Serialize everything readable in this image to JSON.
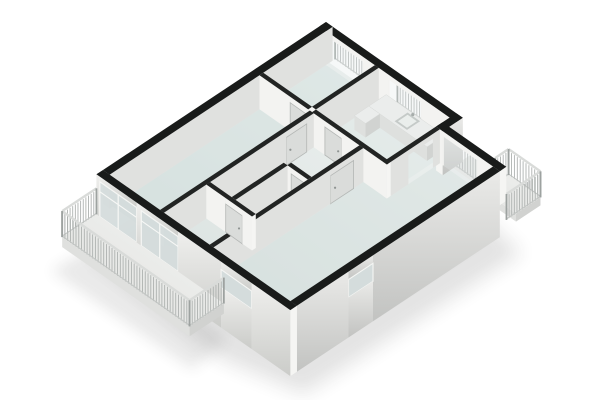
{
  "title": "3D apartment floor plan render",
  "canvas": {
    "width": 600,
    "height": 400,
    "background": "#ffffff"
  },
  "projection": {
    "origin": [
      326,
      22
    ],
    "ux": [
      27.7,
      19.4
    ],
    "vy": [
      -27.2,
      18.05
    ],
    "floor_dz": 34
  },
  "palette": {
    "background": "#ffffff",
    "cap_ext": "#191b1a",
    "cap_int": "#222423",
    "face_int_sw": "#f3f3f1",
    "face_int_se": "#e0e1df",
    "face_ext_sw_top": "#efefed",
    "face_ext_sw_bot": "#cbccc9",
    "face_ext_se_top": "#eaeae8",
    "face_ext_se_bot": "#c2c3c1",
    "wall_end": "#f5f5f3",
    "door": "#dadcda",
    "door_edge": "#b4b7b5",
    "door_handle": "#8f9492",
    "glass": "#d4dcdc",
    "glass_tint": "#e3eaea",
    "frame": "#f7f8f6",
    "jamb": "#f2f2f0",
    "floor_ne": "#f1f4f3",
    "floor_sw": "#d6dfdd",
    "room_tint": "#cfdedb",
    "slab_top": "#f3f4f2",
    "slab_edge": "#dfe0de",
    "slab_end": "#d1d2d0",
    "rail_bar": "#aeb2b0",
    "rail_top": "#d9dbd9",
    "rail_bottom": "#c3c6c4",
    "rail_post": "#9da2a0",
    "counter_top": "#ebedec",
    "counter_front": "#dee0de",
    "counter_end": "#d1d3d1",
    "sink_rim": "#c5cac8",
    "sink_basin": "#eaeeec",
    "faucet": "#a6acaa",
    "shadow": "#303332"
  },
  "scene": {
    "floor": {
      "name": "apartment-floor",
      "dz": 34,
      "outline": [
        [
          0.12,
          0.12
        ],
        [
          4.82,
          0.12
        ],
        [
          4.82,
          0.62
        ],
        [
          6.88,
          0.62
        ],
        [
          6.88,
          8.08
        ],
        [
          0.12,
          8.08
        ]
      ],
      "rooms": [
        {
          "name": "bedroom-floor",
          "opacity": 0.45,
          "pts": [
            [
              0.24,
              0.24
            ],
            [
              2.0,
              0.24
            ],
            [
              2.0,
              2.55
            ],
            [
              0.24,
              2.55
            ]
          ]
        },
        {
          "name": "kitchen-floor",
          "opacity": 0.22,
          "pts": [
            [
              2.14,
              0.24
            ],
            [
              4.7,
              0.24
            ],
            [
              4.7,
              2.55
            ],
            [
              2.14,
              2.55
            ]
          ]
        },
        {
          "name": "left-bedroom-floor",
          "opacity": 0.45,
          "pts": [
            [
              0.24,
              2.69
            ],
            [
              2.06,
              2.69
            ],
            [
              2.06,
              8.08
            ],
            [
              0.24,
              8.08
            ]
          ]
        },
        {
          "name": "bathroom-floor",
          "opacity": 0.3,
          "pts": [
            [
              2.2,
              4.59
            ],
            [
              2.98,
              4.59
            ],
            [
              2.98,
              6.5
            ],
            [
              2.2,
              6.5
            ]
          ]
        },
        {
          "name": "living-room-floor",
          "opacity": 0.38,
          "pts": [
            [
              4.84,
              0.74
            ],
            [
              6.88,
              0.74
            ],
            [
              6.88,
              8.08
            ],
            [
              3.99,
              8.08
            ],
            [
              3.99,
              2.69
            ],
            [
              4.84,
              2.69
            ]
          ]
        }
      ]
    },
    "elements": [
      {
        "t": "shadow",
        "name": "building-shadow",
        "dz": 78,
        "opacity": 0.13,
        "blur": 9,
        "pts": [
          [
            -0.1,
            -0.1
          ],
          [
            5.0,
            0.0
          ],
          [
            7.5,
            0.45
          ],
          [
            7.4,
            8.35
          ],
          [
            4.9,
            9.0
          ],
          [
            -0.2,
            8.55
          ]
        ]
      },
      {
        "t": "shadow",
        "name": "balcony-shadow",
        "dz": 70,
        "opacity": 0.1,
        "blur": 7,
        "pts": [
          [
            0.0,
            8.5
          ],
          [
            4.8,
            8.5
          ],
          [
            5.0,
            10.0
          ],
          [
            -0.1,
            10.0
          ]
        ]
      },
      {
        "t": "slab",
        "name": "ne-balcony-floor",
        "rect": [
          5.0,
          -0.4,
          2.35,
          0.9
        ],
        "top": 40,
        "edge": 48
      },
      {
        "t": "railing",
        "name": "ne-balcony-railing-outer",
        "from": [
          6.2,
          -0.4
        ],
        "to": [
          7.35,
          -0.4
        ],
        "top": 14,
        "bot": 40
      },
      {
        "t": "railing",
        "name": "ne-balcony-railing-return",
        "from": [
          6.2,
          -0.4
        ],
        "to": [
          6.2,
          0.1
        ],
        "top": 14,
        "bot": 40
      },
      {
        "t": "railing",
        "name": "bedroom-french-railing",
        "from": [
          0.25,
          -0.08
        ],
        "to": [
          1.6,
          -0.08
        ],
        "top": 12,
        "bot": 34
      },
      {
        "t": "railing",
        "name": "kitchen-french-railing",
        "from": [
          2.5,
          -0.08
        ],
        "to": [
          3.7,
          -0.08
        ],
        "top": 12,
        "bot": 34
      },
      {
        "t": "railing",
        "name": "living-window-railing",
        "from": [
          4.95,
          0.42
        ],
        "to": [
          6.2,
          0.42
        ],
        "top": 12,
        "bot": 38
      },
      {
        "t": "floor"
      },
      {
        "t": "wall",
        "name": "wall-ne-facade-upper",
        "rect": [
          0,
          0,
          4.94,
          0.24
        ],
        "dir": "x",
        "outer": false,
        "ext": true,
        "bottom": 34,
        "parts": [
          [
            "solid",
            0,
            0.25
          ],
          [
            "win",
            0.25,
            1.6
          ],
          [
            "solid",
            1.6,
            2.5
          ],
          [
            "win",
            2.5,
            3.7
          ],
          [
            "solid",
            3.7,
            4.94
          ]
        ]
      },
      {
        "t": "wall",
        "name": "wall-bedroom-kitchen-divider",
        "rect": [
          2.0,
          0.24,
          0.14,
          2.31
        ],
        "dir": "y",
        "outer": false,
        "ext": false,
        "bottom": 34,
        "parts": [
          [
            "solid",
            0.24,
            2.55
          ]
        ]
      },
      {
        "t": "box",
        "name": "kitchen-counter",
        "rect": [
          2.45,
          0.28,
          2.1,
          0.64
        ],
        "top": 20,
        "bot": 34
      },
      {
        "t": "sink",
        "name": "kitchen-sink",
        "rect": [
          3.3,
          0.36,
          0.45,
          0.48
        ],
        "top": 20
      },
      {
        "t": "box",
        "name": "kitchen-counter-return",
        "rect": [
          2.45,
          0.92,
          0.4,
          0.53
        ],
        "top": 20,
        "bot": 34
      },
      {
        "t": "wall",
        "name": "wall-nw-facade",
        "rect": [
          0,
          0,
          0.24,
          8.2
        ],
        "dir": "y",
        "outer": false,
        "ext": true,
        "bottom": 34,
        "parts": [
          [
            "solid",
            0,
            8.2
          ]
        ]
      },
      {
        "t": "wall",
        "name": "wall-bedroom-south",
        "rect": [
          0.24,
          2.55,
          1.76,
          0.14
        ],
        "dir": "x",
        "outer": false,
        "ext": false,
        "bottom": 34,
        "parts": [
          [
            "solid",
            0.24,
            1.35
          ],
          [
            "door",
            1.35,
            1.95
          ],
          [
            "solid",
            1.95,
            2.0
          ]
        ]
      },
      {
        "t": "wall",
        "name": "wall-ne-step",
        "rect": [
          4.7,
          0,
          0.24,
          0.74
        ],
        "dir": "y",
        "outer": true,
        "ext": true,
        "bottom": 44,
        "parts": [
          [
            "solid",
            0,
            0.74
          ]
        ]
      },
      {
        "t": "wall",
        "name": "wall-ne-facade-living",
        "rect": [
          4.7,
          0.5,
          2.3,
          0.24
        ],
        "dir": "x",
        "outer": false,
        "ext": true,
        "bottom": 34,
        "parts": [
          [
            "solid",
            4.7,
            4.95
          ],
          [
            "win",
            4.95,
            6.2
          ],
          [
            "solid",
            6.2,
            7.0
          ]
        ]
      },
      {
        "t": "wall",
        "name": "wall-kitchen-living-divider",
        "rect": [
          4.7,
          0.74,
          0.14,
          1.95
        ],
        "dir": "y",
        "outer": false,
        "ext": false,
        "bottom": 34,
        "parts": [
          [
            "solid",
            0.74,
            1.0
          ],
          [
            "open",
            1.0,
            1.9
          ],
          [
            "solid",
            1.9,
            2.69
          ]
        ]
      },
      {
        "t": "wall",
        "name": "wall-kitchen-south",
        "rect": [
          2.14,
          2.55,
          2.7,
          0.14
        ],
        "dir": "x",
        "outer": false,
        "ext": false,
        "bottom": 34,
        "parts": [
          [
            "solid",
            2.14,
            2.6
          ],
          [
            "door",
            2.6,
            3.2
          ],
          [
            "solid",
            3.2,
            4.84
          ]
        ]
      },
      {
        "t": "wall",
        "name": "wall-bath-north",
        "rect": [
          2.2,
          4.45,
          1.65,
          0.14
        ],
        "dir": "x",
        "outer": false,
        "ext": false,
        "bottom": 34,
        "parts": [
          [
            "solid",
            2.2,
            2.45
          ],
          [
            "door",
            2.45,
            3.0
          ],
          [
            "solid",
            3.0,
            3.25
          ],
          [
            "door",
            3.25,
            3.75
          ],
          [
            "solid",
            3.75,
            3.85
          ]
        ]
      },
      {
        "t": "wall",
        "name": "wall-left-bedroom-east",
        "rect": [
          2.06,
          2.69,
          0.14,
          5.51
        ],
        "dir": "y",
        "outer": false,
        "ext": false,
        "bottom": 34,
        "parts": [
          [
            "solid",
            2.69,
            2.95
          ],
          [
            "door",
            2.95,
            3.7
          ],
          [
            "solid",
            3.7,
            8.2
          ]
        ]
      },
      {
        "t": "wall",
        "name": "wall-bath-wc-divider",
        "rect": [
          2.98,
          4.59,
          0.14,
          1.91
        ],
        "dir": "y",
        "outer": false,
        "ext": false,
        "bottom": 34,
        "parts": [
          [
            "solid",
            4.59,
            6.5
          ]
        ]
      },
      {
        "t": "wall",
        "name": "wall-hall-living-divider",
        "rect": [
          3.85,
          2.69,
          0.14,
          5.51
        ],
        "dir": "y",
        "outer": false,
        "ext": false,
        "bottom": 34,
        "parts": [
          [
            "solid",
            2.69,
            3.05
          ],
          [
            "door",
            3.05,
            3.9
          ],
          [
            "solid",
            3.9,
            8.2
          ]
        ]
      },
      {
        "t": "wall",
        "name": "wall-bath-south",
        "rect": [
          2.2,
          6.5,
          1.65,
          0.14
        ],
        "dir": "x",
        "outer": false,
        "ext": false,
        "bottom": 34,
        "parts": [
          [
            "solid",
            2.2,
            2.9
          ],
          [
            "door",
            2.9,
            3.5
          ],
          [
            "solid",
            3.5,
            3.85
          ]
        ]
      },
      {
        "t": "wall",
        "name": "wall-se-facade",
        "rect": [
          6.76,
          0.74,
          0.24,
          7.46
        ],
        "dir": "y",
        "outer": true,
        "ext": true,
        "bottom": 66,
        "parts": [
          [
            "solid",
            0.74,
            5.4
          ],
          [
            "sill",
            5.4,
            6.3
          ],
          [
            "solid",
            6.3,
            8.2
          ]
        ]
      },
      {
        "t": "wall",
        "name": "wall-sw-facade",
        "rect": [
          0,
          8.2,
          7.0,
          0.24
        ],
        "dir": "x",
        "outer": true,
        "ext": true,
        "bottom": 66,
        "parts": [
          [
            "solid",
            0,
            0.12
          ],
          [
            "glass",
            0.12,
            1.45
          ],
          [
            "solid",
            1.45,
            1.62
          ],
          [
            "glass",
            1.62,
            2.95
          ],
          [
            "solid",
            2.95,
            4.5
          ],
          [
            "sill",
            4.5,
            5.6
          ],
          [
            "solid",
            5.6,
            7.0
          ]
        ]
      },
      {
        "t": "railing",
        "name": "ne-balcony-railing-front",
        "from": [
          7.35,
          -0.4
        ],
        "to": [
          7.35,
          0.85
        ],
        "top": 14,
        "bot": 40
      },
      {
        "t": "slab",
        "name": "sw-balcony-floor",
        "rect": [
          0,
          8.44,
          4.6,
          1.26
        ],
        "top": 40,
        "edge": 50
      },
      {
        "t": "railing",
        "name": "sw-balcony-railing-left",
        "from": [
          0.0,
          8.44
        ],
        "to": [
          0.0,
          9.7
        ],
        "top": 14,
        "bot": 40
      },
      {
        "t": "railing",
        "name": "sw-balcony-railing-outer",
        "from": [
          0.0,
          9.7
        ],
        "to": [
          4.6,
          9.7
        ],
        "top": 14,
        "bot": 40
      },
      {
        "t": "railing",
        "name": "sw-balcony-railing-right",
        "from": [
          4.6,
          8.44
        ],
        "to": [
          4.6,
          9.7
        ],
        "top": 14,
        "bot": 40
      }
    ]
  }
}
